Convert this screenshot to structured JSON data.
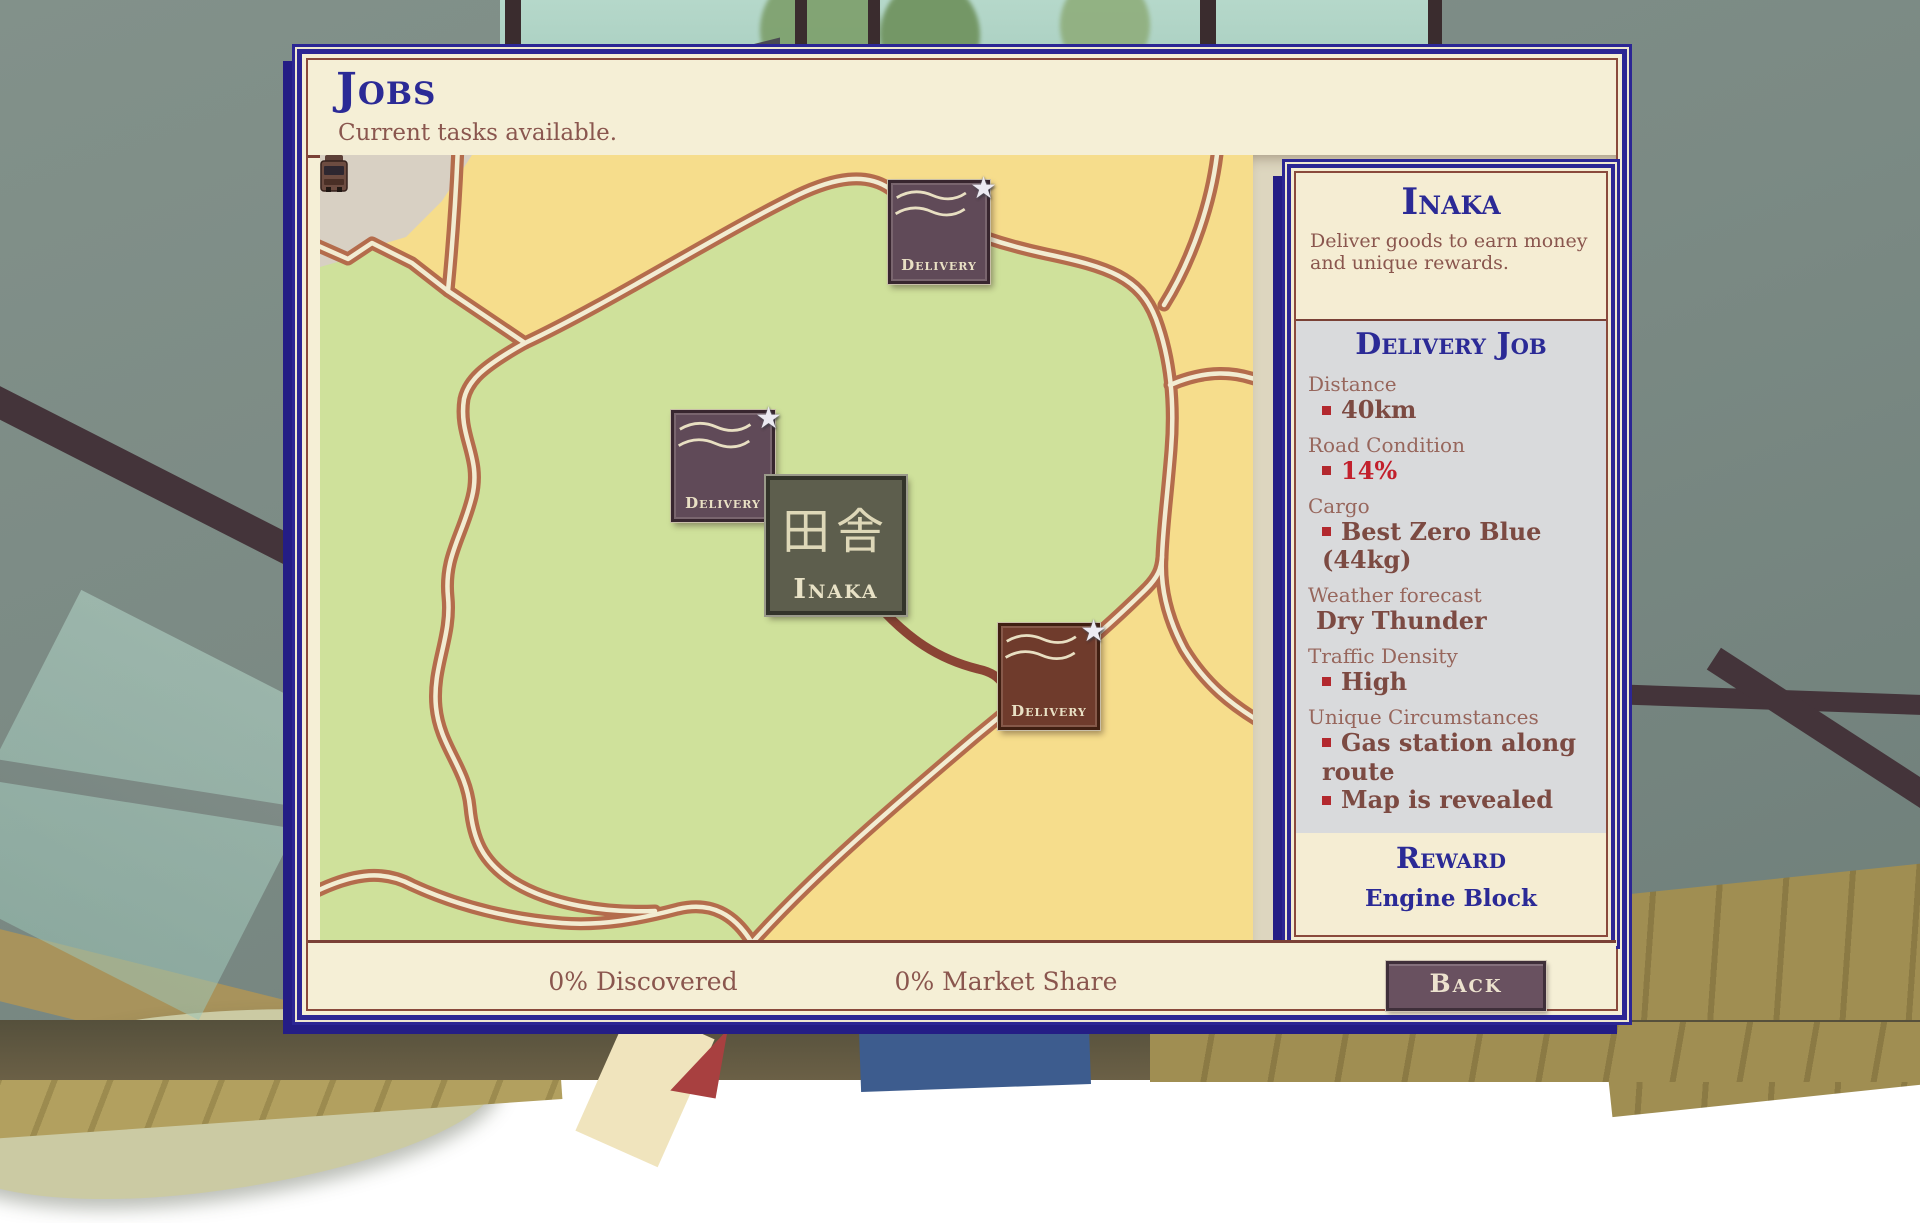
{
  "header": {
    "title": "Jobs",
    "subtitle": "Current tasks available."
  },
  "map": {
    "markers": [
      {
        "label": "Delivery"
      },
      {
        "label": "Delivery"
      },
      {
        "label": "Delivery"
      }
    ],
    "town_sign": {
      "kanji": "田舎",
      "name": "Inaka"
    }
  },
  "sidebar": {
    "title": "Inaka",
    "description": "Deliver goods to earn money and unique rewards.",
    "job_title": "Delivery Job",
    "fields": [
      {
        "label": "Distance",
        "items": [
          {
            "text": "40km"
          }
        ]
      },
      {
        "label": "Road Condition",
        "items": [
          {
            "text": "14%"
          }
        ]
      },
      {
        "label": "Cargo",
        "items": [
          {
            "text": "Best Zero Blue (44kg)"
          }
        ]
      },
      {
        "label": "Weather forecast",
        "items": [
          {
            "text": "Dry Thunder"
          }
        ]
      },
      {
        "label": "Traffic Density",
        "items": [
          {
            "text": "High"
          }
        ]
      },
      {
        "label": "Unique Circumstances",
        "items": [
          {
            "text": "Gas station along route"
          },
          {
            "text": "Map is revealed"
          }
        ]
      }
    ],
    "reward_title": "Reward",
    "reward_value": "Engine Block"
  },
  "footer": {
    "discovered": "0% Discovered",
    "market_share": "0% Market Share",
    "back_label": "Back"
  },
  "colors": {
    "accent_navy": "#2b2a96",
    "text_brown": "#8a564e",
    "alert_red": "#c2202c",
    "map_green": "#cfe19b",
    "map_yellow": "#f6dd8c",
    "road_brown": "#b46c4c",
    "panel_cream": "#f5efd6"
  }
}
